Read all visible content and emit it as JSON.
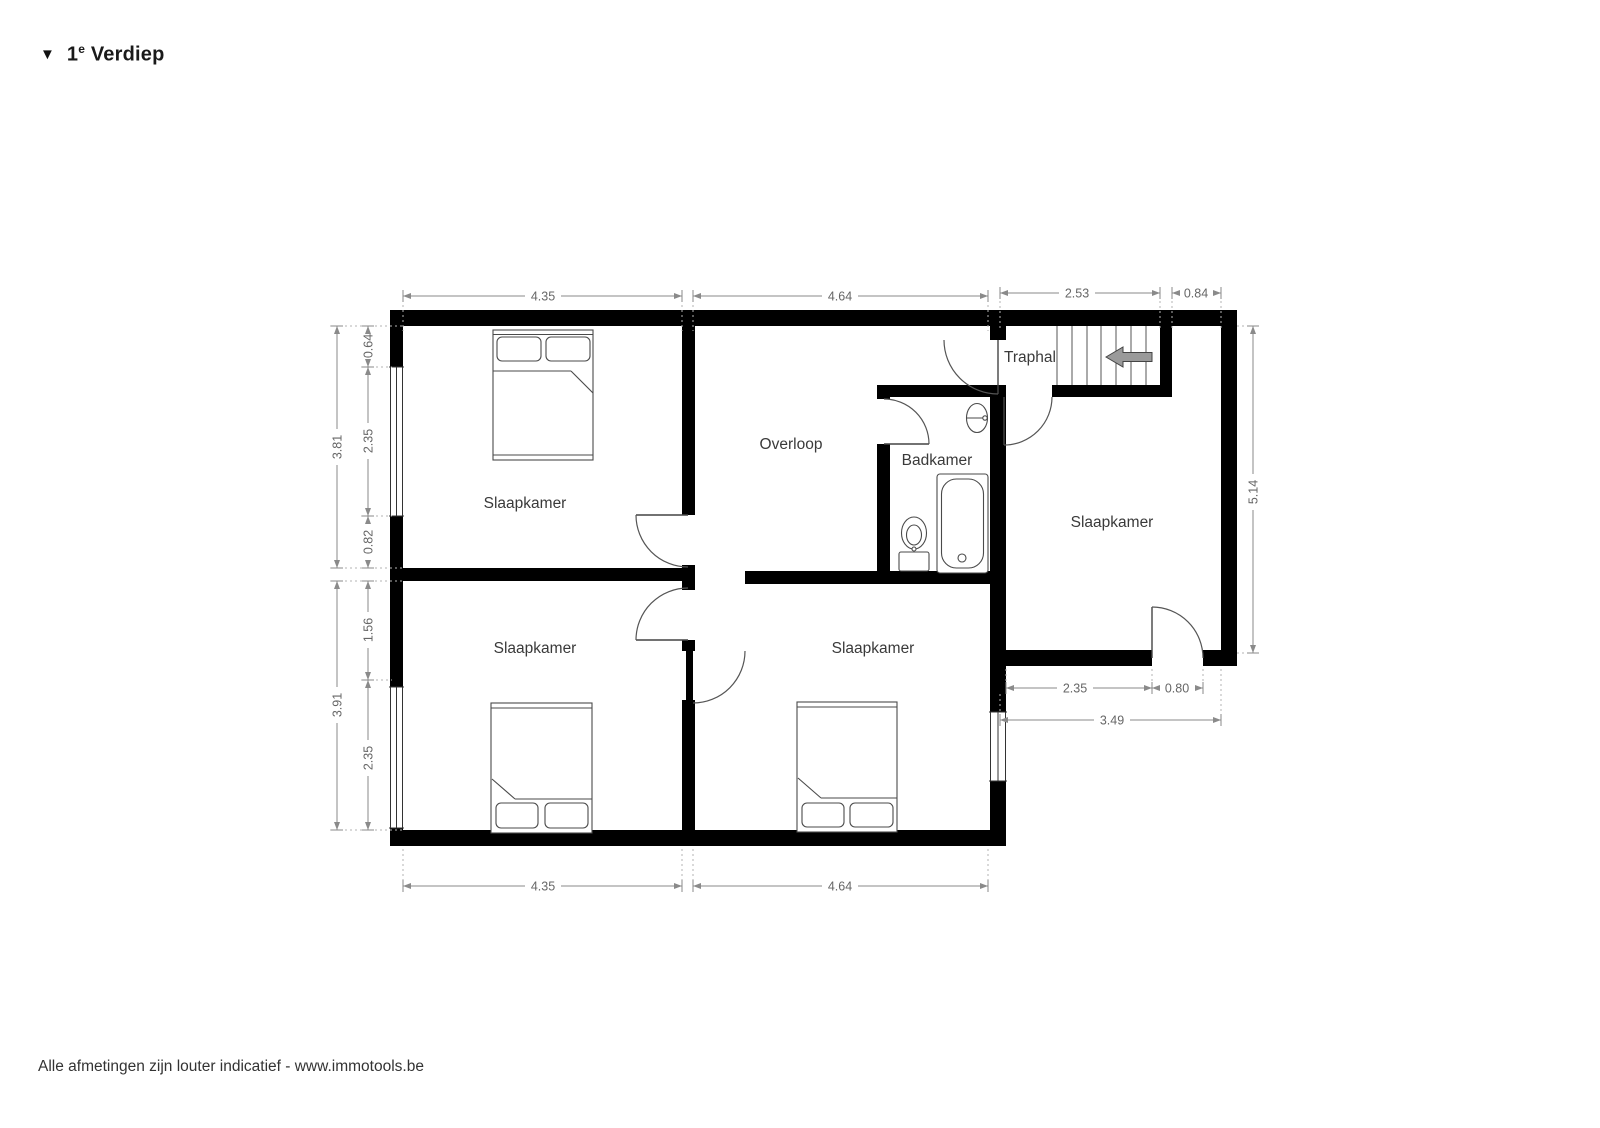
{
  "title": {
    "marker": "▼",
    "number": "1",
    "ordinal": "e",
    "name": "Verdiep"
  },
  "footer": {
    "text": "Alle afmetingen zijn louter indicatief - www.immotools.be"
  },
  "rooms": {
    "bedroom_top_left": "Slaapkamer",
    "bedroom_bottom_left": "Slaapkamer",
    "bedroom_bottom_middle": "Slaapkamer",
    "bedroom_right": "Slaapkamer",
    "hallway": "Overloop",
    "bathroom": "Badkamer",
    "stair_hall": "Traphal"
  },
  "dimensions": {
    "top": [
      "4.35",
      "4.64",
      "2.53",
      "0.84"
    ],
    "bottom": [
      "4.35",
      "4.64"
    ],
    "left_outer": [
      "3.81",
      "3.91"
    ],
    "left_inner": [
      "0.64",
      "2.35",
      "0.82",
      "1.56",
      "2.35"
    ],
    "right": [
      "5.14"
    ],
    "bottom_right": [
      "2.35",
      "0.80",
      "3.49"
    ]
  },
  "icons": {
    "stairs_direction_arrow": "left-arrow",
    "floor_marker": "down-triangle"
  },
  "colors": {
    "wall": "#000000",
    "dim_line": "#8a8a8a",
    "dim_text": "#666666",
    "room_label": "#3a3a3a",
    "stairs_arrow_fill": "#9a9a9a",
    "background": "#ffffff"
  }
}
